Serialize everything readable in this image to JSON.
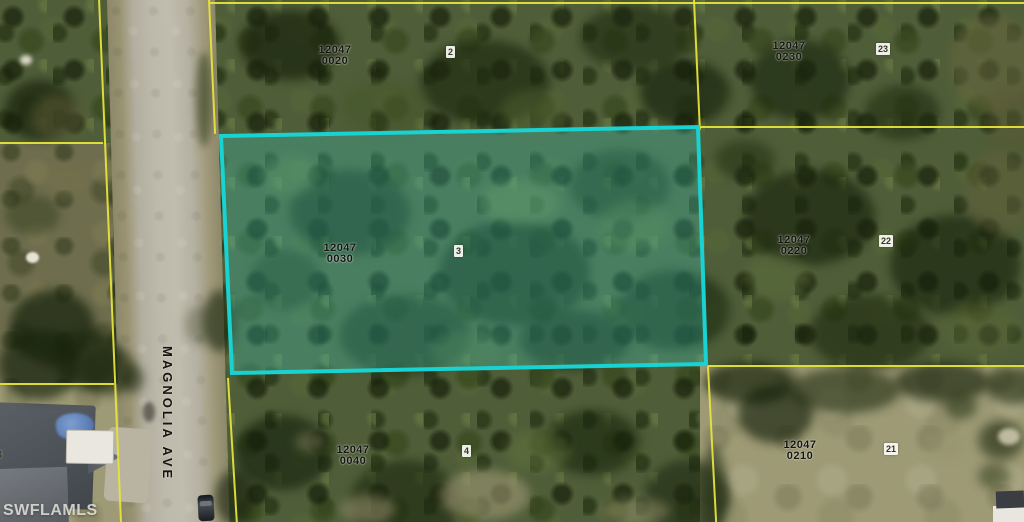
{
  "map": {
    "watermark": "SWFLAMLS",
    "street": "MAGNOLIA AVE",
    "parcels": [
      {
        "block": "12047",
        "lot": "0020",
        "marker": "2"
      },
      {
        "block": "12047",
        "lot": "0230",
        "marker": "23"
      },
      {
        "block": "12047",
        "lot": "0030",
        "marker": "3",
        "highlighted": true
      },
      {
        "block": "12047",
        "lot": "0220",
        "marker": "22"
      },
      {
        "block": "12047",
        "lot": "0040",
        "marker": "4"
      },
      {
        "block": "12047",
        "lot": "0210",
        "marker": "21"
      }
    ],
    "edge_label": "3",
    "highlight": {
      "border_color": "#19d3d3",
      "fill_color": "rgba(64,214,204,0.27)"
    },
    "colors": {
      "parcel_line": "#e6e33c"
    }
  }
}
